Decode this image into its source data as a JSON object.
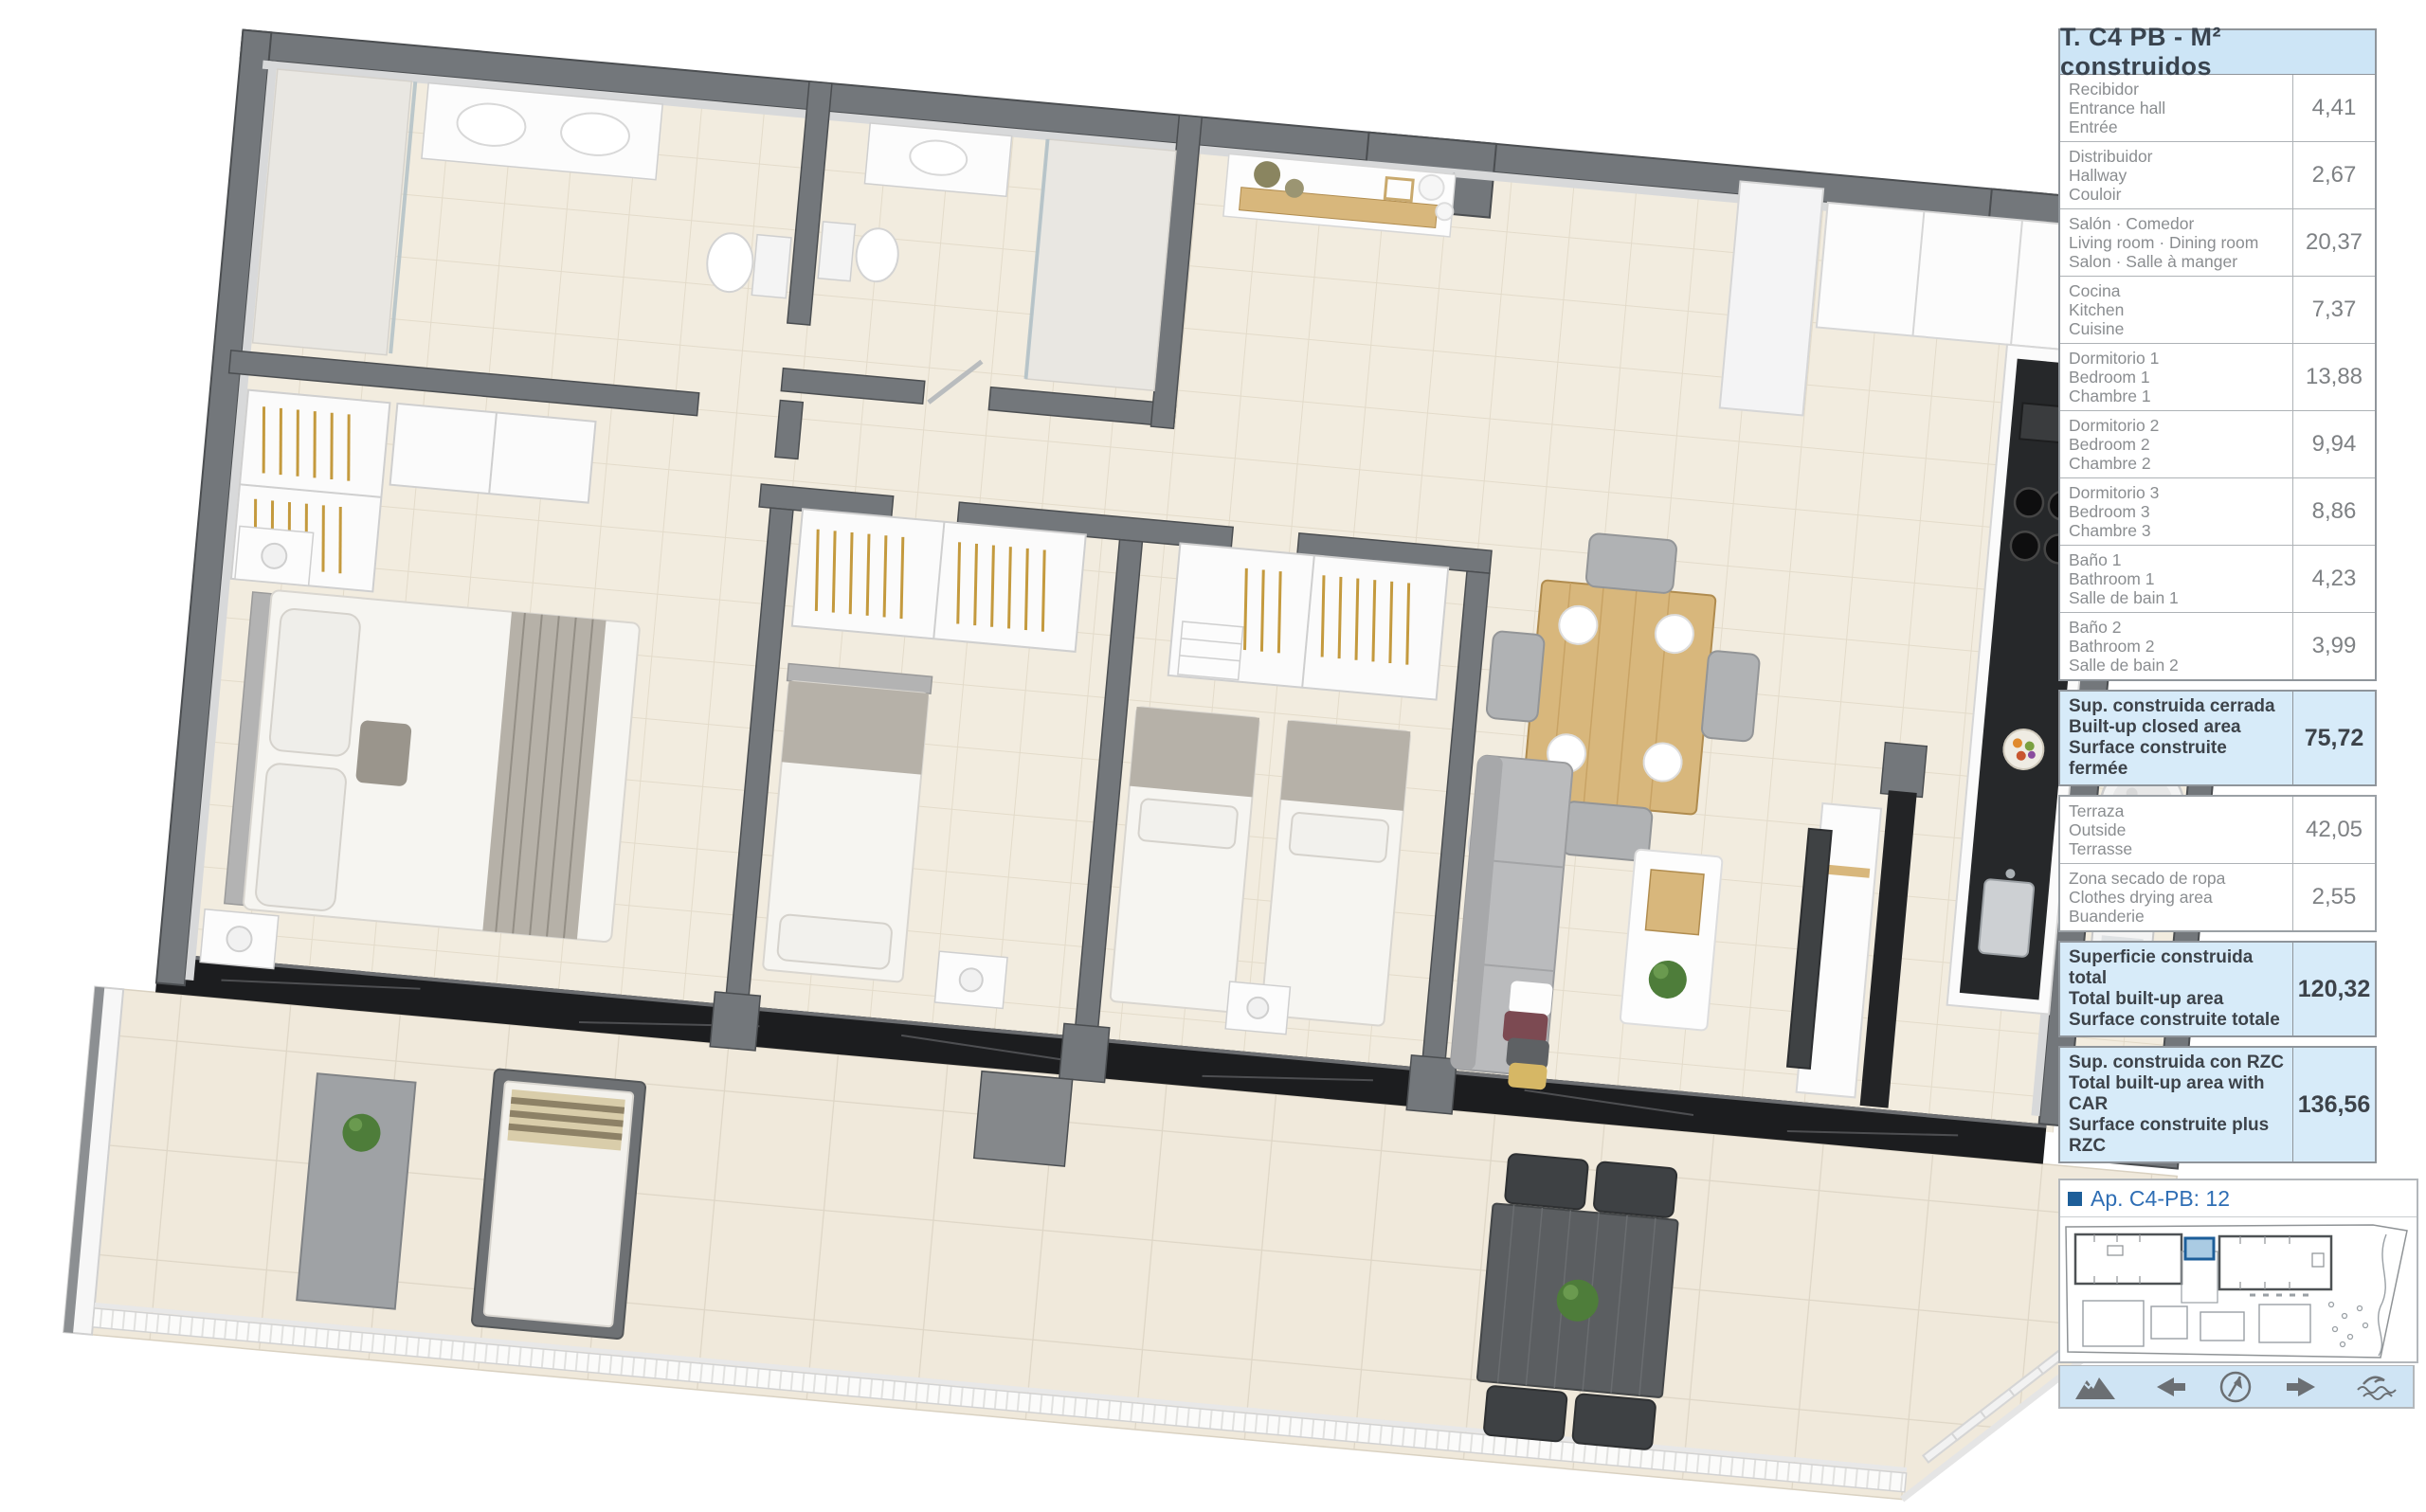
{
  "panel": {
    "header": "T. C4 PB  -  M² construidos",
    "rows": [
      {
        "es": "Recibidor",
        "en": "Entrance hall",
        "fr": "Entrée",
        "value": "4,41"
      },
      {
        "es": "Distribuidor",
        "en": "Hallway",
        "fr": "Couloir",
        "value": "2,67"
      },
      {
        "es": "Salón · Comedor",
        "en": "Living room · Dining room",
        "fr": "Salon · Salle à manger",
        "value": "20,37"
      },
      {
        "es": "Cocina",
        "en": "Kitchen",
        "fr": "Cuisine",
        "value": "7,37"
      },
      {
        "es": "Dormitorio 1",
        "en": "Bedroom 1",
        "fr": "Chambre 1",
        "value": "13,88"
      },
      {
        "es": "Dormitorio 2",
        "en": "Bedroom 2",
        "fr": "Chambre 2",
        "value": "9,94"
      },
      {
        "es": "Dormitorio 3",
        "en": "Bedroom 3",
        "fr": "Chambre 3",
        "value": "8,86"
      },
      {
        "es": "Baño 1",
        "en": "Bathroom 1",
        "fr": "Salle de bain 1",
        "value": "4,23"
      },
      {
        "es": "Baño 2",
        "en": "Bathroom 2",
        "fr": "Salle de bain 2",
        "value": "3,99"
      }
    ],
    "closed_area": {
      "es": "Sup. construida cerrada",
      "en": "Built-up closed area",
      "fr": "Surface construite fermée",
      "value": "75,72"
    },
    "outdoor_rows": [
      {
        "es": "Terraza",
        "en": "Outside",
        "fr": "Terrasse",
        "value": "42,05"
      },
      {
        "es": "Zona secado de ropa",
        "en": "Clothes drying area",
        "fr": "Buanderie",
        "value": "2,55"
      }
    ],
    "total_area": {
      "es": "Superficie construida total",
      "en": "Total built-up area",
      "fr": "Surface construite totale",
      "value": "120,32"
    },
    "rzc_area": {
      "es": "Sup. construida con RZC",
      "en": "Total built-up area with CAR",
      "fr": "Surface construite plus RZC",
      "value": "136,56"
    },
    "apartment_ref": "Ap. C4-PB: 12",
    "footer_icons": [
      "mountains-icon",
      "arrow-left-icon",
      "compass-icon",
      "arrow-right-icon",
      "waves-icon"
    ]
  },
  "colors": {
    "header_bg": "#cde5f6",
    "highlight_bg": "#d7ebf9",
    "accent_blue": "#2f6eb4",
    "unit_marker_blue": "#1d5e99",
    "table_border": "#9aa0a5",
    "label_gray": "#8a8d90",
    "value_gray": "#7e8184",
    "dark_text": "#3d434a",
    "wall_gray": "#73777b",
    "floor_cream": "#f2ecdf",
    "marble_black": "#1c1d1f",
    "wood": "#d8b77c",
    "footer_bg": "#cfe4f4",
    "icon_gray": "#6b6f73"
  }
}
